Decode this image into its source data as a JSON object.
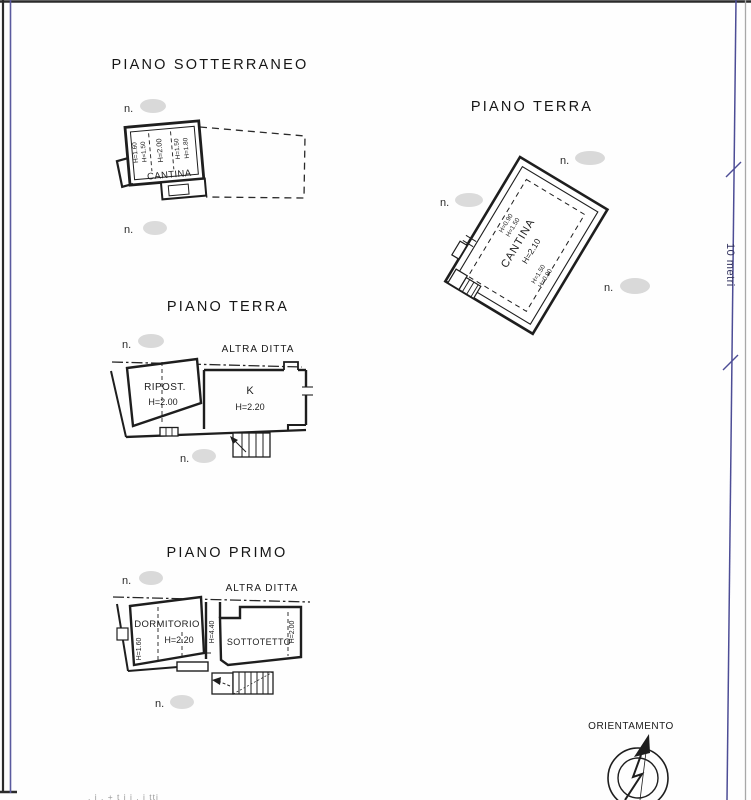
{
  "page": {
    "scale_label": "10 metri",
    "parcel_label": "n.",
    "illegible_note": ". i . + t i i . i tti"
  },
  "plans": {
    "sotterraneo": {
      "title": "PIANO SOTTERRANEO",
      "room": "CANTINA",
      "heights": [
        "H=1.60",
        "H=1.50",
        "H=2.00",
        "H=1.50",
        "H=1.80"
      ]
    },
    "terra_right": {
      "title": "PIANO TERRA",
      "room": "CANTINA",
      "room_height": "H=2.10",
      "heights_upper": [
        "H=0.90",
        "H=1.50"
      ],
      "heights_lower": [
        "H=1.50",
        "H=0.90"
      ]
    },
    "terra_left": {
      "title": "PIANO TERRA",
      "boundary_label": "ALTRA DITTA",
      "rooms": [
        {
          "name": "RIPOST.",
          "height": "H=2.00"
        },
        {
          "name": "K",
          "height": "H=2.20"
        }
      ]
    },
    "primo": {
      "title": "PIANO PRIMO",
      "boundary_label": "ALTRA DITTA",
      "rooms": [
        {
          "name": "DORMITORIO",
          "height": "H=2.20"
        },
        {
          "name": "SOTTOTETTO",
          "height": "H=2.00"
        }
      ],
      "side_heights": [
        "H=1.60",
        "H=4.40"
      ]
    }
  },
  "compass": {
    "label": "ORIENTAMENTO"
  }
}
